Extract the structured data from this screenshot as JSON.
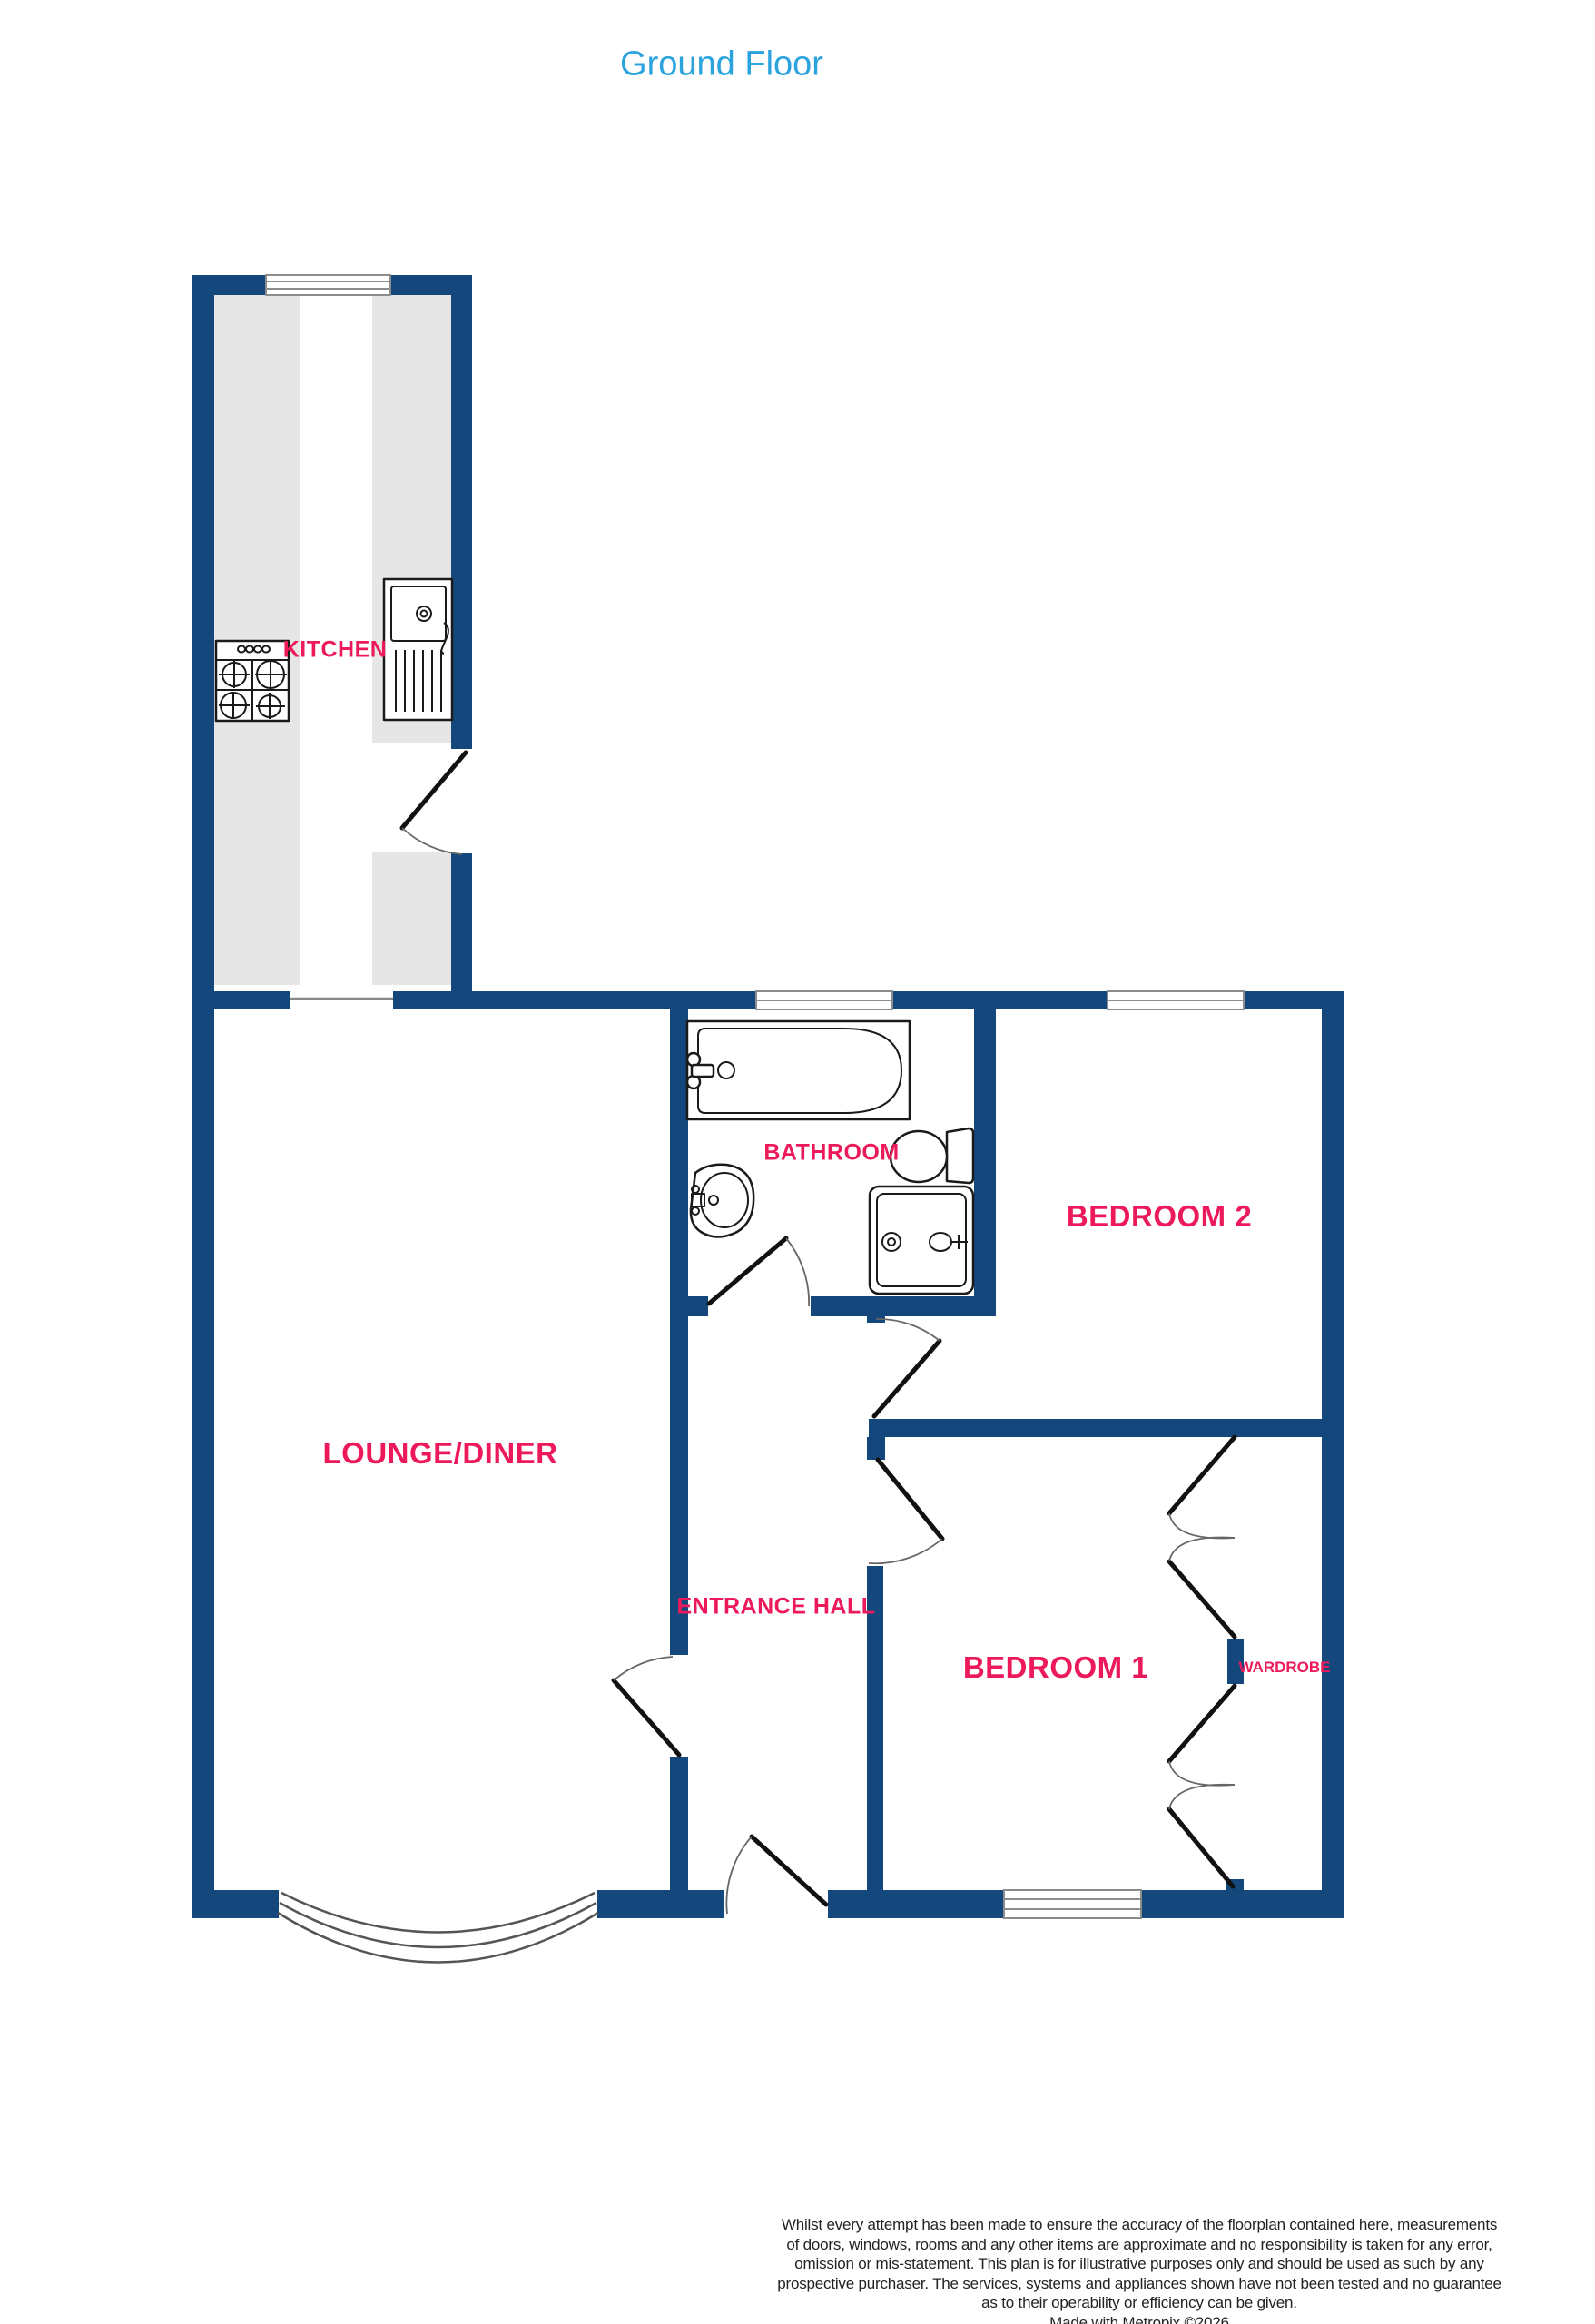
{
  "title": {
    "text": "Ground Floor"
  },
  "rooms": {
    "kitchen": {
      "label": "KITCHEN"
    },
    "lounge": {
      "label": "LOUNGE/DINER"
    },
    "bathroom": {
      "label": "BATHROOM"
    },
    "bedroom2": {
      "label": "BEDROOM 2"
    },
    "bedroom1": {
      "label": "BEDROOM 1"
    },
    "hall": {
      "label": "ENTRANCE HALL"
    },
    "wardrobe": {
      "label": "WARDROBE"
    }
  },
  "disclaimer": {
    "lines": [
      "Whilst every attempt has been made to ensure the accuracy of the floorplan contained here, measurements",
      "of doors, windows, rooms and any other items are approximate and no responsibility is taken for any error,",
      "omission or mis-statement. This plan is for illustrative purposes only and should be used as such by any",
      "prospective purchaser. The services, systems and appliances shown have not been tested and no guarantee",
      "as to their operability or efficiency can be given.",
      "Made with Metropix ©2026"
    ]
  },
  "colors": {
    "wall": "#14477C",
    "counter": "#E6E6E6",
    "window_frame": "#8C8C8C",
    "room_label": "#ED1A5B",
    "title": "#2BA4DE",
    "fixture_stroke": "#1a1a1a",
    "door_leaf": "#111111",
    "door_arc": "#666666",
    "disclaimer_text": "#222222"
  }
}
